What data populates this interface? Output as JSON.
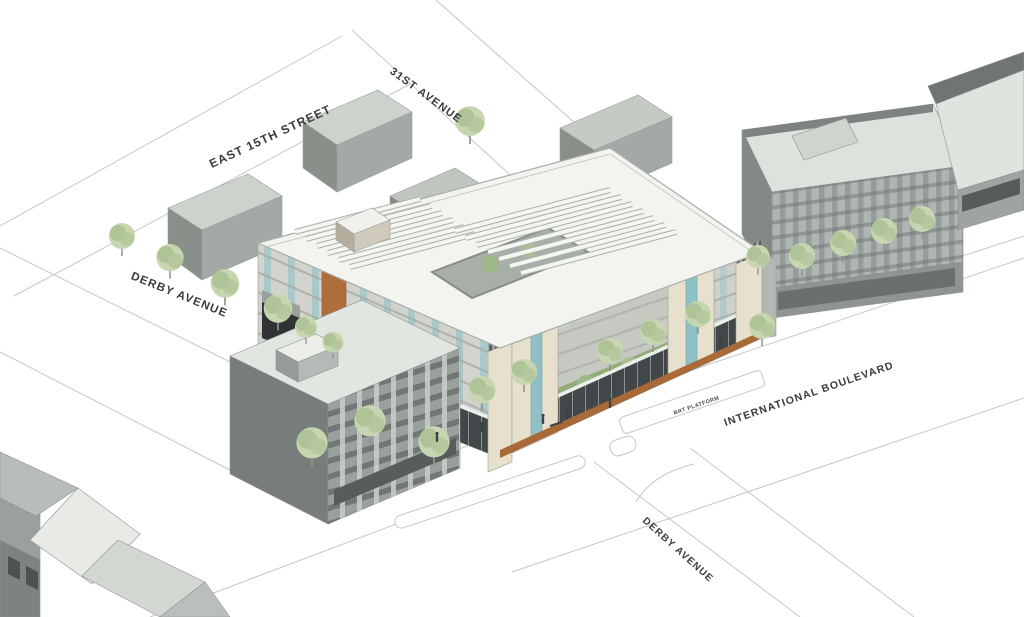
{
  "scene": {
    "type": "architectural-site-rendering",
    "description": "Aerial rendering of a mixed-use residential block on International Boulevard with BRT platform",
    "labels": {
      "east_15th_street": "EAST 15TH STREET",
      "thirty_first_avenue": "31ST AVENUE",
      "derby_avenue_west": "DERBY AVENUE",
      "international_boulevard": "INTERNATIONAL BOULEVARD",
      "brt_platform": "BRT PLATFORM",
      "derby_avenue_south": "DERBY AVENUE"
    },
    "colors": {
      "background": "#ffffff",
      "street_line": "#c6c7c5",
      "label_text": "#3a3a3a",
      "main_roof": "#f3f4ef",
      "main_facade_gray": "#d2d3cc",
      "window_glass_teal": "#9fc6c9",
      "accent_wood_orange": "#a96a38",
      "accent_tan": "#e6e0cc",
      "storefront_dark": "#42474a",
      "context_building_gray": "#9aa09e",
      "tree_foliage": "#c7d6b0"
    }
  }
}
